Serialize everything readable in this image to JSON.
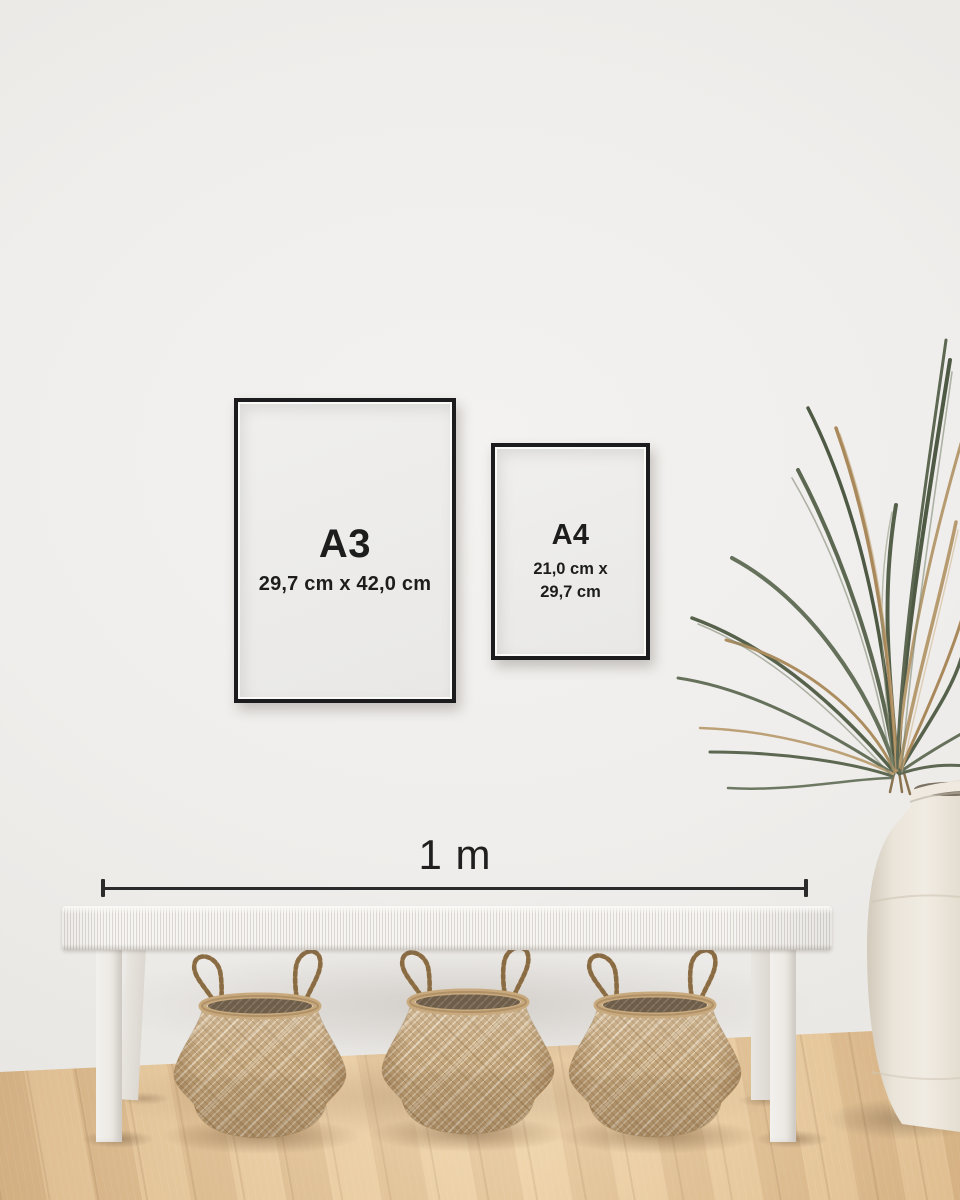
{
  "posters": {
    "a3": {
      "label": "A3",
      "dimensions": "29,7 cm x 42,0 cm"
    },
    "a4": {
      "label": "A4",
      "dimensions_line1": "21,0 cm x",
      "dimensions_line2": "29,7 cm"
    }
  },
  "scale_bar": {
    "label": "1 m"
  },
  "decor_objects": {
    "bench": "white-woven-bench",
    "baskets": [
      "seagrass-belly-basket",
      "seagrass-belly-basket",
      "seagrass-belly-basket"
    ],
    "plant": "dried-palm-plant",
    "vase": "white-ceramic-floor-vase",
    "wall": "white-plaster-wall",
    "floor": "light-oak-wood-floor"
  },
  "colors": {
    "frame_black": "#1c1c1e",
    "poster_white": "#edecea",
    "text_dark": "#1d1d1d",
    "wall": "#f0eeec",
    "floor_wood": "#d8b385",
    "basket_weave": "#c2a47a",
    "plant_green": "#5d6852",
    "plant_dried": "#a9895c",
    "vase_cream": "#e9e3d9",
    "bench_white": "#f4f2ef",
    "scale_line": "#2b2b2b"
  }
}
